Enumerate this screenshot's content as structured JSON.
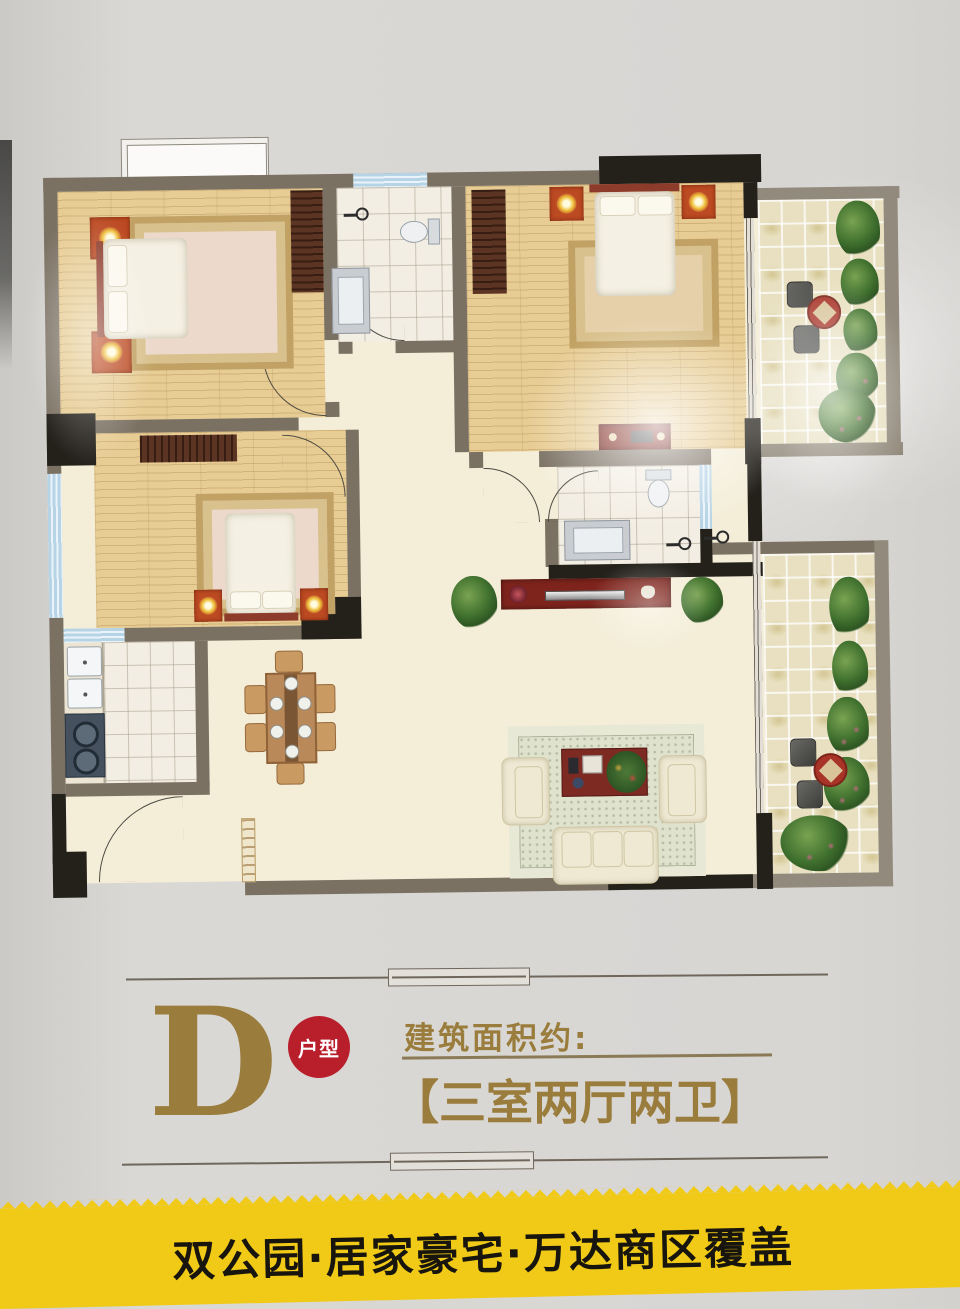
{
  "unit": {
    "letter": "D",
    "tag": "户型"
  },
  "area": {
    "label": "建筑面积约:",
    "layout": "【三室两厅两卫】"
  },
  "banner": {
    "text": "双公园·居家豪宅·万达商区覆盖"
  },
  "colors": {
    "gold": "#9a7c3c",
    "badge_red": "#b91f2b",
    "banner_yellow": "#f0ca16",
    "banner_text": "#17150e",
    "wall_taupe": "#7b7163",
    "wall_black": "#24211b",
    "wood_floor": "#e7cc93",
    "window_blue": "#b7d4e6"
  },
  "floorplan": {
    "rooms": [
      "bedroom-top-left",
      "bathroom-top",
      "master-bedroom",
      "balcony-top-right",
      "bedroom-middle-left",
      "bathroom-middle",
      "kitchen",
      "dining-area",
      "living-room",
      "balcony-bottom-right",
      "entry"
    ]
  }
}
